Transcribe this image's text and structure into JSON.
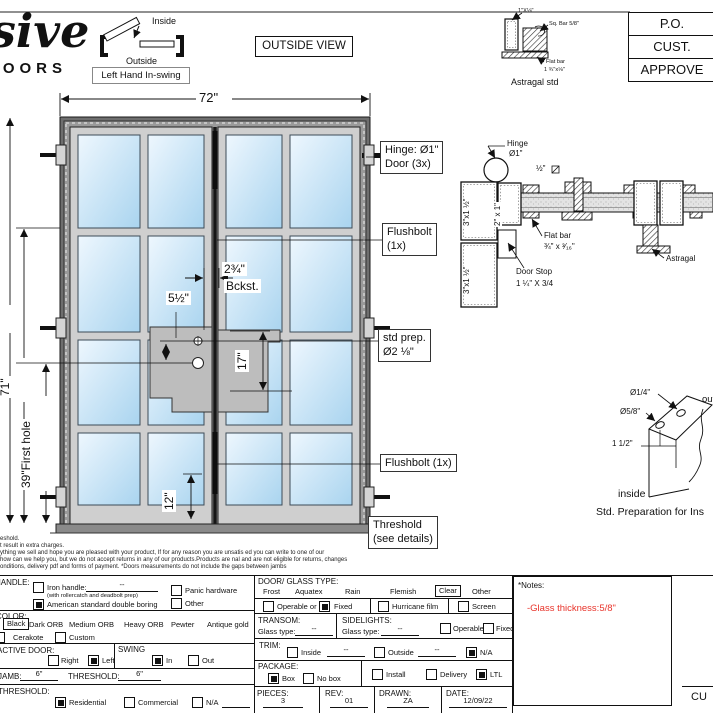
{
  "logo": {
    "script": "sive",
    "caps": "DOORS"
  },
  "swing_diagram": {
    "inside": "Inside",
    "outside": "Outside",
    "label": "Left Hand In-swing"
  },
  "view_label": "OUTSIDE VIEW",
  "approval_table": {
    "rows": [
      "P.O.",
      "CUST.",
      "APPROVE"
    ]
  },
  "astragal_detail": {
    "tube_size": "1\"X⅛\"",
    "sq_bar": "Sq. Bar 5/8\"",
    "flat_bar_label": "Flat bar",
    "flat_bar_size": "1 ¾\"x⅛\"",
    "title": "Astragal std"
  },
  "elevation": {
    "width": "72\"",
    "height_fragment": "8",
    "height_71": "71\"",
    "first_hole": "39\"First hole",
    "backset_value": "2¾\"",
    "backset_label": "Bckst.",
    "hole_spacing": "5½\"",
    "dim_17": "17\"",
    "dim_12": "12\"",
    "callout_hinge_1": "Hinge: Ø1\"",
    "callout_hinge_2": "Door (3x)",
    "callout_flushbolt_1": "Flushbolt",
    "callout_flushbolt_2": "(1x)",
    "callout_stdprep_1": "std prep.",
    "callout_stdprep_2": "Ø2 ⅛\"",
    "callout_flushbolt_bottom": "Flushbolt (1x)",
    "callout_threshold_1": "Threshold",
    "callout_threshold_2": "(see details)"
  },
  "section_detail": {
    "hinge_label": "Hinge",
    "hinge_size": "Ø1\"",
    "half_bar": "½\"",
    "jamb_tube_a": "3\"x1 ½\"",
    "jamb_tube_b": "3\"x1 ½\"",
    "door_tube": "2\" x 1\"",
    "flat_bar_label": "Flat bar",
    "flat_bar_size": "¾\" x ³⁄₁₆\"",
    "door_stop_label": "Door Stop",
    "door_stop_size": "1 ¼\" X 3/4",
    "astragal_label": "Astragal"
  },
  "prep_detail": {
    "dia_quarter": "Ø1/4\"",
    "dia_fiveeighths": "Ø5/8\"",
    "dim_onehalf": "1 1/2\"",
    "outside": "outside",
    "inside": "inside",
    "title": "Std. Preparation for Ins"
  },
  "disclaimer": {
    "lines": [
      "eshold.",
      "t result in extra charges.",
      "ything we sell and hope you are pleased with your product, If for any reason you are unsatis  ed you can write to one of our",
      "how can we help you, but we do not accept returns in any of our products.Products are   nal and are not eligible for returns, changes",
      "onditions, delivery pdf and forms of payment. *Doors measurements do not include the gaps between jambs"
    ]
  },
  "form": {
    "handle": {
      "label": "HANDLE:",
      "iron": "Iron handle:",
      "iron_value": "--",
      "iron_sub": "(with rollercatch and deadbolt prep)",
      "american": "American standard double boring",
      "panic": "Panic hardware",
      "other": "Other"
    },
    "color": {
      "label": "COLOR:",
      "selected": "Black",
      "opt_dark": "Dark ORB",
      "opt_medium": "Medium ORB",
      "opt_heavy": "Heavy ORB",
      "opt_pewter": "Pewter",
      "opt_antique": "Antique gold",
      "cerakote": "Cerakote",
      "custom": "Custom"
    },
    "active_door": {
      "label": "ACTIVE DOOR:",
      "right": "Right",
      "left": "Left"
    },
    "swing": {
      "label": "SWING",
      "in": "In",
      "out": "Out"
    },
    "jamb": {
      "label": "JAMB:",
      "value": "6\"",
      "threshold_label": "THRESHOLD:",
      "threshold_value": "6\""
    },
    "threshold": {
      "label": "THRESHOLD:",
      "residential": "Residential",
      "commercial": "Commercial",
      "na": "N/A"
    },
    "glass": {
      "label": "DOOR/ GLASS TYPE:",
      "opt_frost": "Frost",
      "opt_aquatex": "Aquatex",
      "opt_rain": "Rain",
      "opt_flemish": "Flemish",
      "selected": "Clear",
      "opt_other": "Other",
      "operable": "Operable  or",
      "fixed": "Fixed",
      "hurricane": "Hurricane film",
      "screen": "Screen"
    },
    "transom": {
      "label": "TRANSOM:",
      "glass_type": "Glass type:",
      "value": "--"
    },
    "sidelights": {
      "label": "SIDELIGHTS:",
      "glass_type": "Glass type:",
      "value": "--",
      "operable": "Operable",
      "fixed": "Fixed"
    },
    "trim": {
      "label": "TRIM:",
      "inside": "Inside",
      "inside_value": "--",
      "outside": "Outside",
      "outside_value": "--",
      "na": "N/A"
    },
    "package": {
      "label": "PACKAGE:",
      "box": "Box",
      "no_box": "No box",
      "install": "Install",
      "delivery": "Delivery",
      "ltl": "LTL"
    },
    "pieces": {
      "label": "PIECES:",
      "value": "3"
    },
    "rev": {
      "label": "REV:",
      "value": "01"
    },
    "drawn": {
      "label": "DRAWN:",
      "value": "ZA"
    },
    "date": {
      "label": "DATE:",
      "value": "12/09/22"
    }
  },
  "notes": {
    "title": "*Notes:",
    "glass_thickness": "-Glass thickness:5/8\"",
    "note_color": "#e8332a"
  },
  "footer": {
    "signature": "CU"
  }
}
